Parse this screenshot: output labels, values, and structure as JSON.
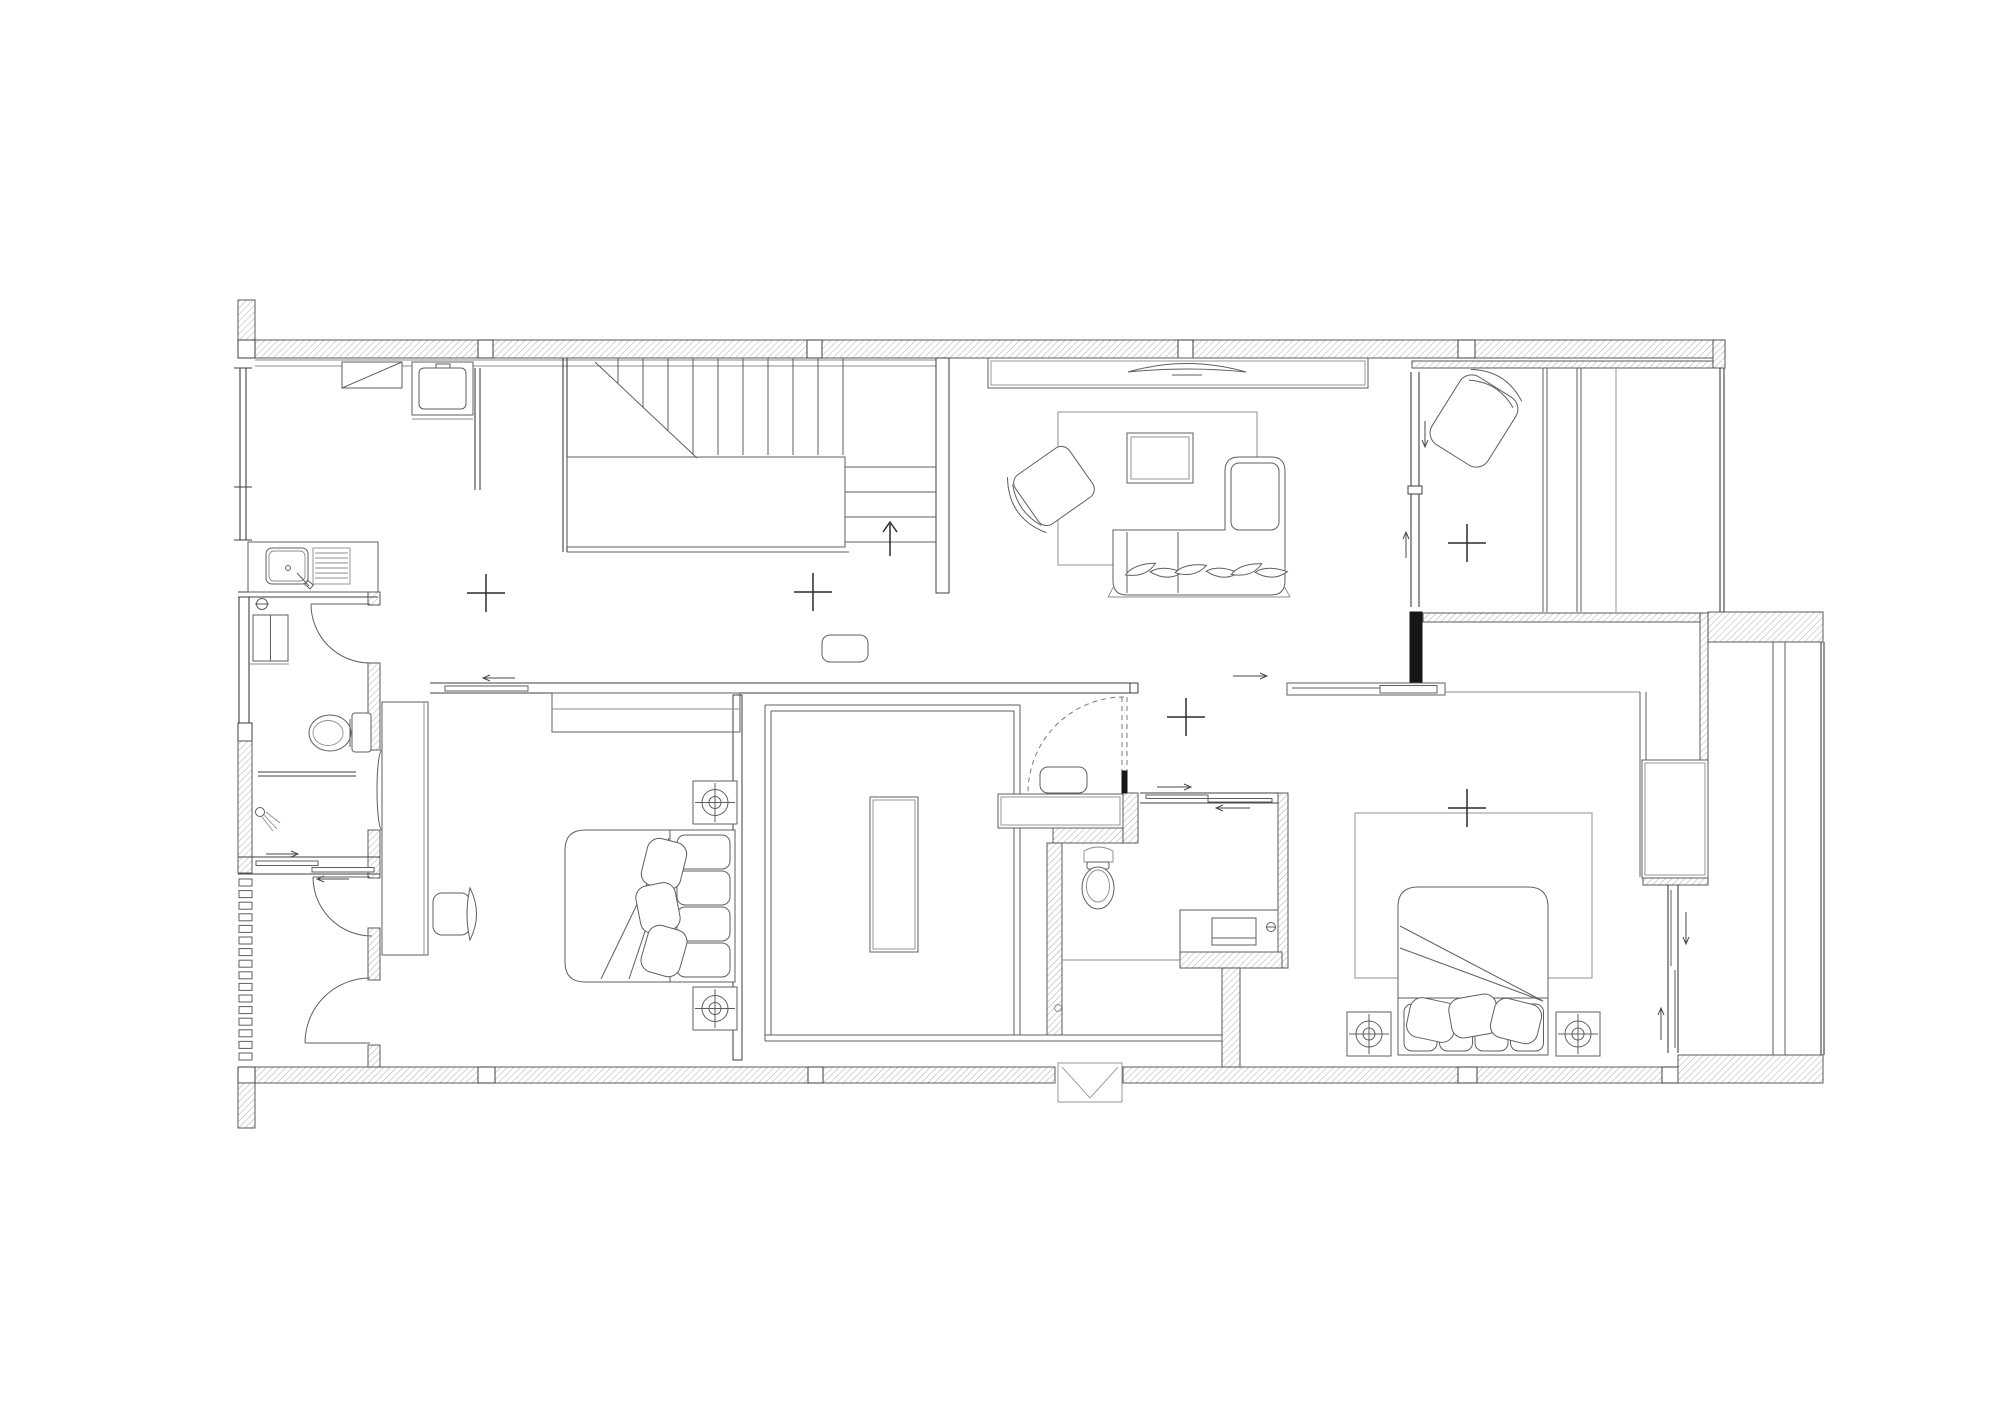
{
  "document": {
    "type": "architectural-floor-plan",
    "description": "Black-and-white residential floor plan, top view line drawing, no text labels visible",
    "background": "#ffffff"
  },
  "palette": {
    "wall_outline": "#3f3f3f",
    "hatch_line": "#9a9a9a",
    "furniture_line": "#5f5f5f",
    "light_detail_line": "#8c8c8c",
    "rug_line": "#9c9c9c",
    "solid_filled_column": "#161616",
    "dashed_door_swing": "#7a7a7a"
  },
  "rooms": [
    {
      "name": "kitchen-laundry",
      "position": "top-left"
    },
    {
      "name": "stair-hall",
      "position": "top-center"
    },
    {
      "name": "living-room",
      "position": "top-center-right"
    },
    {
      "name": "lounge-room",
      "position": "top-right"
    },
    {
      "name": "bathroom-left",
      "position": "left"
    },
    {
      "name": "shower-room",
      "position": "left-lower"
    },
    {
      "name": "drying-room",
      "position": "bottom-left"
    },
    {
      "name": "bedroom-study",
      "position": "bottom-center-left"
    },
    {
      "name": "walk-in-closet",
      "position": "bottom-center"
    },
    {
      "name": "bathroom-middle",
      "position": "center-right"
    },
    {
      "name": "master-bedroom",
      "position": "bottom-right"
    },
    {
      "name": "wardrobe-corridor",
      "position": "far-right"
    }
  ],
  "symbols": [
    {
      "name": "wall-cabinet-icon",
      "room": "kitchen-laundry"
    },
    {
      "name": "washing-machine-icon",
      "room": "kitchen-laundry"
    },
    {
      "name": "kitchen-sink-counter-icon",
      "room": "kitchen-laundry"
    },
    {
      "name": "water-heater-icon",
      "room": "bathroom-left"
    },
    {
      "name": "toilet-icon",
      "room": "bathroom-left"
    },
    {
      "name": "shower-head-icon",
      "room": "shower-room"
    },
    {
      "name": "glass-door-ellipse-icon",
      "room": "shower-room"
    },
    {
      "name": "louver-vent-icon",
      "room": "drying-room"
    },
    {
      "name": "staircase-icon",
      "room": "stair-hall"
    },
    {
      "name": "up-arrow-icon",
      "room": "stair-hall"
    },
    {
      "name": "doormat-icon",
      "room": "stair-hall"
    },
    {
      "name": "tv-console-icon",
      "room": "living-room"
    },
    {
      "name": "tv-icon",
      "room": "living-room"
    },
    {
      "name": "rug-icon",
      "room": "living-room"
    },
    {
      "name": "coffee-table-icon",
      "room": "living-room"
    },
    {
      "name": "armchair-icon",
      "room": "living-room"
    },
    {
      "name": "corner-sofa-icon",
      "room": "living-room"
    },
    {
      "name": "lounge-chair-icon",
      "room": "lounge-room"
    },
    {
      "name": "desk-icon",
      "room": "bedroom-study"
    },
    {
      "name": "desk-chair-icon",
      "room": "bedroom-study"
    },
    {
      "name": "double-bed-icon",
      "room": "bedroom-study"
    },
    {
      "name": "nightstand-lamp-icon",
      "room": "bedroom-study"
    },
    {
      "name": "closet-counter-icon",
      "room": "walk-in-closet"
    },
    {
      "name": "closet-island-icon",
      "room": "walk-in-closet"
    },
    {
      "name": "bench-icon",
      "room": "walk-in-closet"
    },
    {
      "name": "pocket-door-dashed-icon",
      "room": "walk-in-closet"
    },
    {
      "name": "toilet-icon",
      "room": "bathroom-middle"
    },
    {
      "name": "vanity-sink-icon",
      "room": "bathroom-middle"
    },
    {
      "name": "rug-icon",
      "room": "master-bedroom"
    },
    {
      "name": "double-bed-icon",
      "room": "master-bedroom"
    },
    {
      "name": "nightstand-lamp-icon",
      "room": "master-bedroom"
    },
    {
      "name": "wardrobe-icon",
      "room": "wardrobe-corridor"
    },
    {
      "name": "ac-window-box-icon",
      "room": "exterior-bottom"
    },
    {
      "name": "ceiling-light-cross-icon",
      "room": "multiple"
    }
  ],
  "counts": {
    "ceiling_light_crosses": 5,
    "swing_doors": 4,
    "dashed_pocket_doors": 1,
    "sliding_door_tracks": 6,
    "white_wall_columns": 11,
    "upper_stair_treads": 10,
    "lower_stair_treads": 4,
    "louver_slats": 16
  }
}
